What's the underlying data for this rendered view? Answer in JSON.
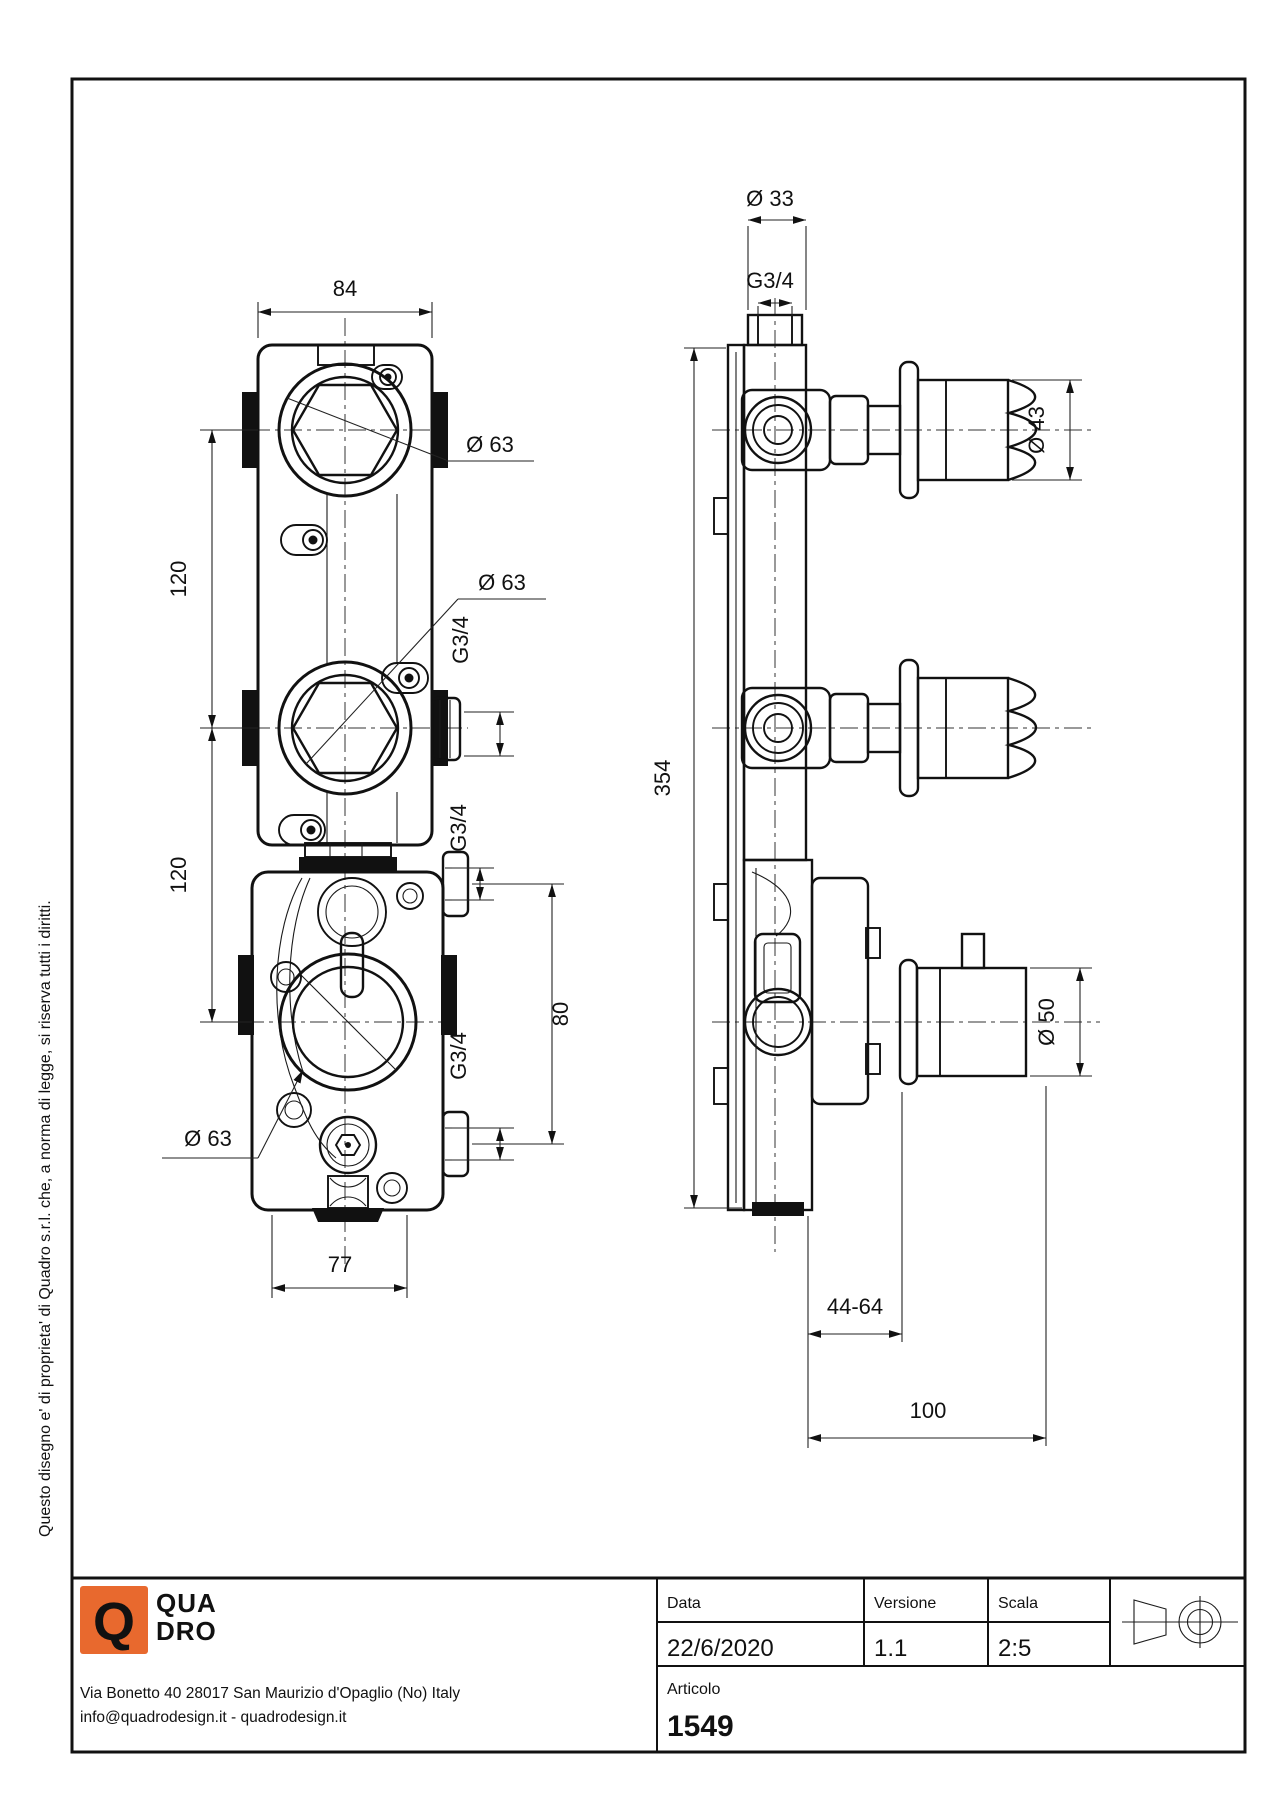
{
  "copyright": "Questo disegno e' di proprieta' di Quadro s.r.l. che, a norma di legge, si riserva tutti i diritti.",
  "front_view": {
    "width_top": "84",
    "width_bottom": "77",
    "pitch_upper": "120",
    "pitch_lower": "120",
    "dia_top": "Ø 63",
    "dia_mid": "Ø 63",
    "dia_bottom": "Ø 63",
    "port_mid": "G3/4",
    "port_upper": "G3/4",
    "port_lower": "G3/4",
    "port_span": "80"
  },
  "side_view": {
    "dia_stub": "Ø 33",
    "thread_stub": "G3/4",
    "overall_height": "354",
    "dia_knob": "Ø 43",
    "dia_knob_low": "Ø 50",
    "depth_range": "44-64",
    "depth_total": "100"
  },
  "title_block": {
    "date_label": "Data",
    "date": "22/6/2020",
    "version_label": "Versione",
    "version": "1.1",
    "scale_label": "Scala",
    "scale": "2:5",
    "article_label": "Articolo",
    "article": "1549"
  },
  "company": {
    "logo_letter": "Q",
    "name_line1": "QUA",
    "name_line2": "DRO",
    "brand_color": "#E8692E",
    "address": "Via Bonetto 40  28017 San Maurizio d'Opaglio (No) Italy",
    "contacts": "info@quadrodesign.it  -  quadrodesign.it"
  }
}
